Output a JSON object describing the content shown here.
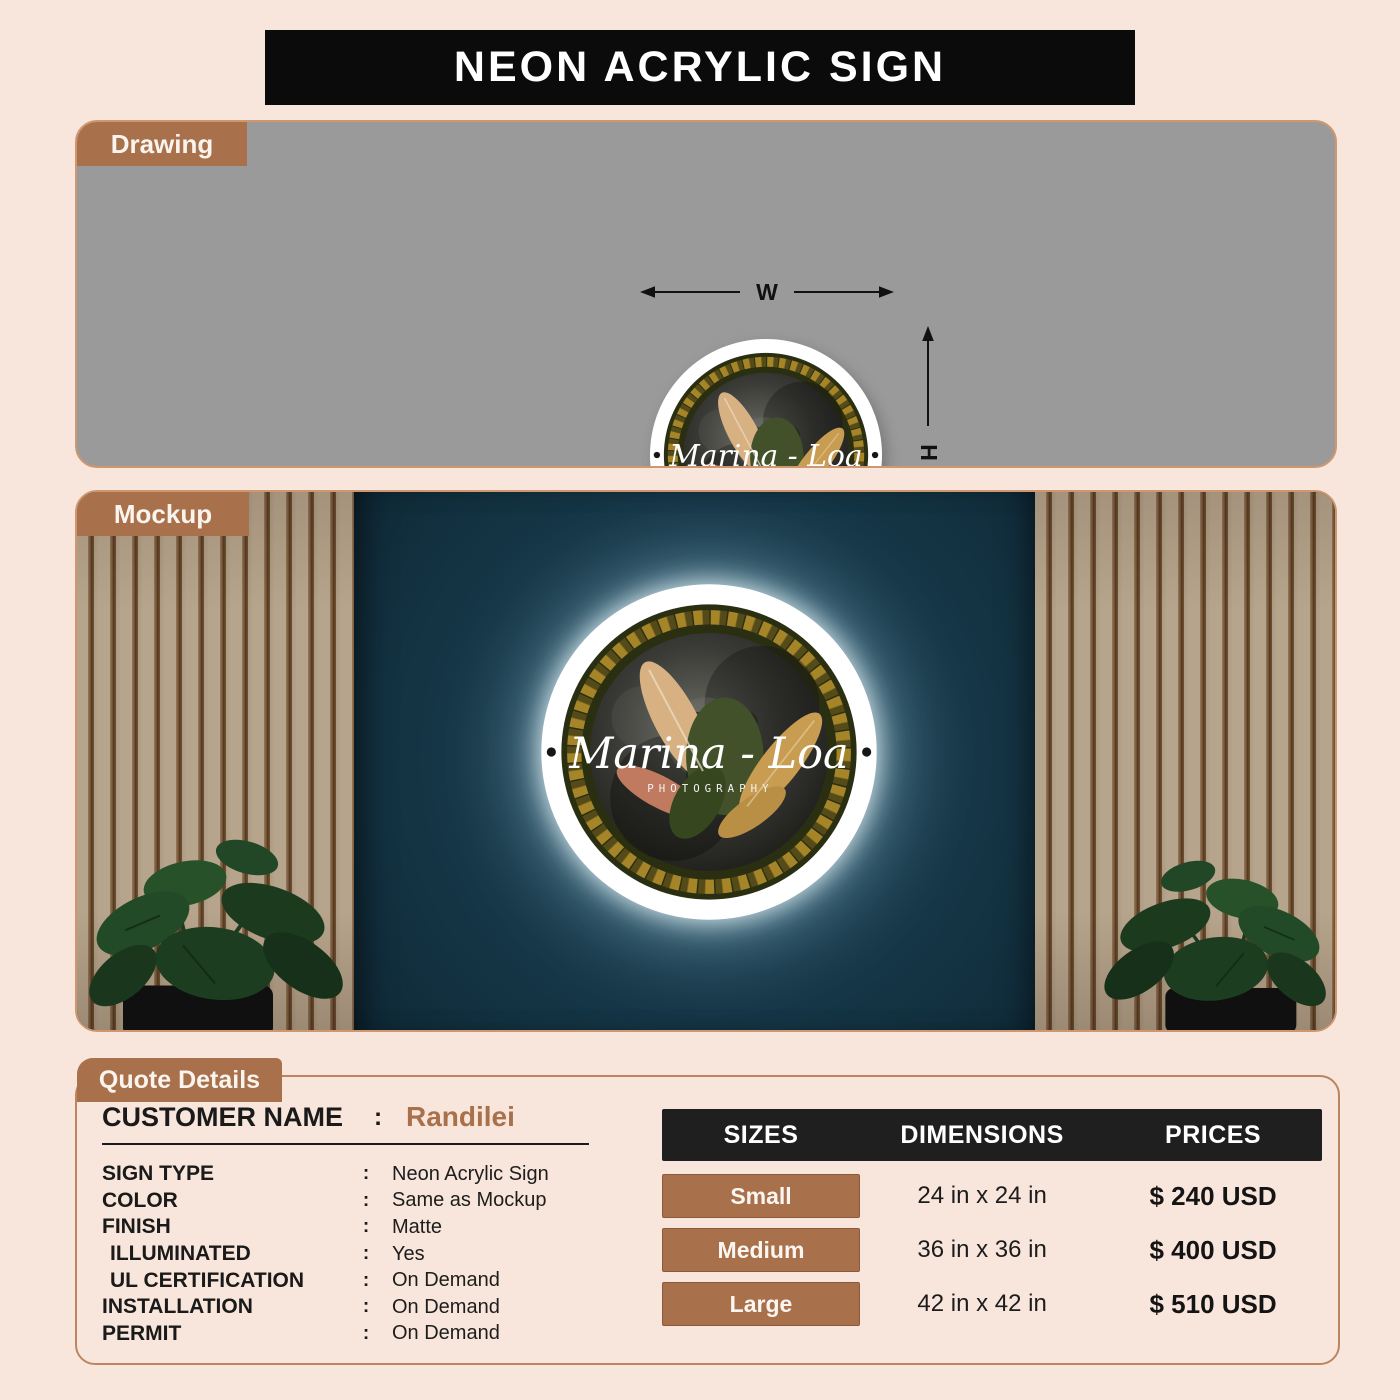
{
  "page": {
    "title": "NEON ACRYLIC SIGN"
  },
  "sections": {
    "drawing": {
      "label": "Drawing",
      "width_label": "W",
      "height_label": "H"
    },
    "mockup": {
      "label": "Mockup"
    },
    "quote": {
      "label": "Quote Details"
    }
  },
  "sign": {
    "brand_line1": "Marina - Loa",
    "brand_line2": "PHOTOGRAPHY"
  },
  "quote": {
    "separator": ":",
    "customer": {
      "label": "CUSTOMER NAME",
      "value": "Randilei"
    },
    "fields": [
      {
        "label": "SIGN TYPE",
        "value": "Neon Acrylic Sign"
      },
      {
        "label": "COLOR",
        "value": "Same as Mockup"
      },
      {
        "label": "FINISH",
        "value": "Matte"
      },
      {
        "label": "ILLUMINATED",
        "value": "Yes"
      },
      {
        "label": "UL CERTIFICATION",
        "value": "On Demand"
      },
      {
        "label": "INSTALLATION",
        "value": "On Demand"
      },
      {
        "label": "PERMIT",
        "value": "On Demand"
      }
    ]
  },
  "pricing": {
    "headers": [
      "SIZES",
      "DIMENSIONS",
      "PRICES"
    ],
    "rows": [
      {
        "size": "Small",
        "dimensions": "24 in x 24 in",
        "price": "$ 240 USD"
      },
      {
        "size": "Medium",
        "dimensions": "36 in x 36 in",
        "price": "$ 400 USD"
      },
      {
        "size": "Large",
        "dimensions": "42 in x 42 in",
        "price": "$ 510 USD"
      }
    ]
  },
  "colors": {
    "page_background": "#f8e6dc",
    "banner_black": "#0b0b0b",
    "accent_brown": "#a9714b",
    "panel_gray": "#9a9a9a",
    "wall_teal": "#17384a",
    "table_header_black": "#1f1f1f",
    "neon_glow_white": "#eefaff"
  }
}
